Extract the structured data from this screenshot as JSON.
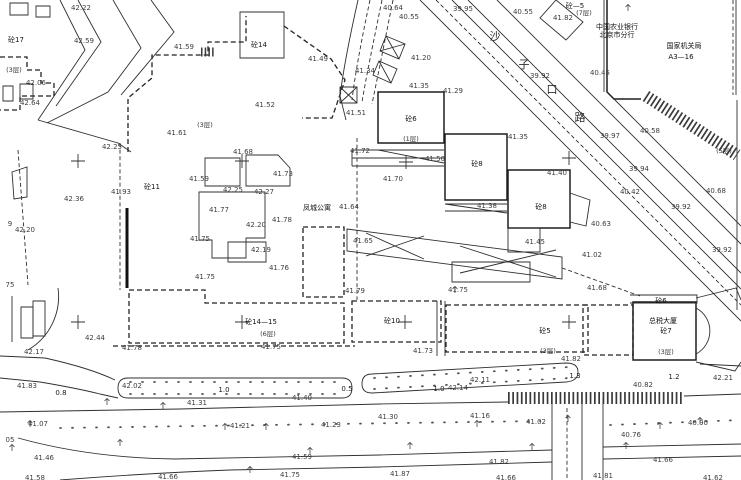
{
  "canvas": {
    "width": 741,
    "height": 480,
    "background": "#ffffff",
    "ink_color": "#2f2f2f",
    "label_color": "#3d3d3d"
  },
  "map": {
    "street_chars": [
      [
        "沙",
        495,
        38
      ],
      [
        "子",
        524,
        66
      ],
      [
        "口",
        552,
        91
      ],
      [
        "路",
        580,
        119
      ]
    ],
    "names": [
      [
        "中国农业银行",
        617,
        27
      ],
      [
        "北京市分行",
        617,
        35
      ],
      [
        "国家机关局",
        684,
        46
      ],
      [
        "A3—16",
        681,
        57
      ],
      [
        "凤城公寓",
        317,
        208
      ],
      [
        "总税大厦",
        663,
        321
      ]
    ],
    "building_numbers": [
      [
        "砼17",
        16,
        40
      ],
      [
        "砼14",
        259,
        45
      ],
      [
        "砼—5",
        575,
        6
      ],
      [
        "砼11",
        152,
        187
      ],
      [
        "砼6",
        411,
        119
      ],
      [
        "砼8",
        477,
        164
      ],
      [
        "砼8",
        541,
        207
      ],
      [
        "砼14—15",
        261,
        322
      ],
      [
        "砼10",
        392,
        321
      ],
      [
        "砼5",
        545,
        331
      ],
      [
        "砼6",
        661,
        301
      ],
      [
        "砼7",
        666,
        331
      ]
    ],
    "floor_notes": [
      [
        "(3层)",
        14,
        70
      ],
      [
        "(3层)",
        205,
        125
      ],
      [
        "(7层)",
        584,
        13
      ],
      [
        "(1层)",
        411,
        139
      ],
      [
        "(5层)",
        724,
        151
      ],
      [
        "(6层)",
        268,
        334
      ],
      [
        "(3层)",
        548,
        351
      ],
      [
        "(3层)",
        666,
        352
      ]
    ],
    "spot_elevations": [
      [
        "42.22",
        81,
        8
      ],
      [
        "42.59",
        84,
        41
      ],
      [
        "41.59",
        184,
        47
      ],
      [
        "42.06",
        36,
        83
      ],
      [
        "42.64",
        30,
        103
      ],
      [
        "42.25",
        112,
        147
      ],
      [
        "41.61",
        177,
        133
      ],
      [
        "40.64",
        393,
        8
      ],
      [
        "40.55",
        409,
        17
      ],
      [
        "39.95",
        463,
        9
      ],
      [
        "40.55",
        523,
        12
      ],
      [
        "41.82",
        563,
        18
      ],
      [
        "40.45",
        600,
        73
      ],
      [
        "39.92",
        540,
        76
      ],
      [
        "40.58",
        650,
        131
      ],
      [
        "39.97",
        610,
        136
      ],
      [
        "41.35",
        518,
        137
      ],
      [
        "39.94",
        639,
        169
      ],
      [
        "40.42",
        630,
        192
      ],
      [
        "39.92",
        681,
        207
      ],
      [
        "40.68",
        716,
        191
      ],
      [
        "39.92",
        722,
        250
      ],
      [
        "41.49",
        318,
        59
      ],
      [
        "41.20",
        421,
        58
      ],
      [
        "41.34",
        365,
        71
      ],
      [
        "41.35",
        419,
        86
      ],
      [
        "41.29",
        453,
        91
      ],
      [
        "41.52",
        265,
        105
      ],
      [
        "41.51",
        356,
        113
      ],
      [
        "41.72",
        360,
        151
      ],
      [
        "41.50",
        435,
        159
      ],
      [
        "41.70",
        393,
        179
      ],
      [
        "41.38",
        487,
        206
      ],
      [
        "41.40",
        557,
        173
      ],
      [
        "40.63",
        601,
        224
      ],
      [
        "41.45",
        535,
        242
      ],
      [
        "41.02",
        592,
        255
      ],
      [
        "41.68",
        597,
        288
      ],
      [
        "41.93",
        121,
        192
      ],
      [
        "42.36",
        74,
        199
      ],
      [
        "42.20",
        25,
        230
      ],
      [
        "9",
        10,
        224
      ],
      [
        "75",
        10,
        285
      ],
      [
        "41.68",
        243,
        152
      ],
      [
        "41.59",
        199,
        179
      ],
      [
        "42.25",
        233,
        190
      ],
      [
        "42.27",
        264,
        192
      ],
      [
        "41.73",
        283,
        174
      ],
      [
        "41.77",
        219,
        210
      ],
      [
        "42.20",
        256,
        225
      ],
      [
        "41.78",
        282,
        220
      ],
      [
        "41.75",
        200,
        239
      ],
      [
        "42.19",
        261,
        250
      ],
      [
        "41.76",
        279,
        268
      ],
      [
        "41.75",
        205,
        277
      ],
      [
        "41.64",
        349,
        207
      ],
      [
        "41.65",
        363,
        241
      ],
      [
        "42.17",
        34,
        352
      ],
      [
        "42.44",
        95,
        338
      ],
      [
        "41.78",
        132,
        348
      ],
      [
        "41.83",
        27,
        386
      ],
      [
        "42.02",
        132,
        386
      ],
      [
        "41.31",
        197,
        403
      ],
      [
        "41.07",
        38,
        424
      ],
      [
        "05",
        10,
        440
      ],
      [
        "41.46",
        44,
        458
      ],
      [
        "41.58",
        35,
        478
      ],
      [
        "41.66",
        168,
        477
      ],
      [
        "41.79",
        355,
        291
      ],
      [
        "41.75",
        271,
        347
      ],
      [
        "41.40",
        302,
        398
      ],
      [
        "41.21",
        240,
        426
      ],
      [
        "41.23",
        331,
        425
      ],
      [
        "41.59",
        302,
        457
      ],
      [
        "41.75",
        290,
        475
      ],
      [
        "41.75",
        458,
        290
      ],
      [
        "41.73",
        423,
        351
      ],
      [
        "41.82",
        571,
        359
      ],
      [
        "42.11",
        480,
        380
      ],
      [
        "42.14",
        458,
        388
      ],
      [
        "41.30",
        388,
        417
      ],
      [
        "41.16",
        480,
        416
      ],
      [
        "41.02",
        536,
        422
      ],
      [
        "41.82",
        499,
        462
      ],
      [
        "41.87",
        400,
        474
      ],
      [
        "41.66",
        506,
        478
      ],
      [
        "42.21",
        723,
        378
      ],
      [
        "40.82",
        643,
        385
      ],
      [
        "40.90",
        698,
        423
      ],
      [
        "40.76",
        631,
        435
      ],
      [
        "41.66",
        663,
        460
      ],
      [
        "41.81",
        603,
        476
      ],
      [
        "41.62",
        713,
        478
      ]
    ],
    "distance_marks": [
      [
        "0.8",
        61,
        393
      ],
      [
        "1.0",
        224,
        390
      ],
      [
        "0.5",
        347,
        389
      ],
      [
        "1.0",
        439,
        389
      ],
      [
        "1.3",
        575,
        376
      ],
      [
        "1.2",
        674,
        377
      ]
    ],
    "grid_crosses": [
      [
        78,
        161
      ],
      [
        242,
        161
      ],
      [
        406,
        162
      ],
      [
        569,
        158
      ],
      [
        78,
        322
      ],
      [
        242,
        322
      ],
      [
        405,
        322
      ],
      [
        569,
        322
      ]
    ],
    "tree_symbols": [
      [
        107,
        402
      ],
      [
        163,
        406
      ],
      [
        225,
        427
      ],
      [
        266,
        427
      ],
      [
        310,
        451
      ],
      [
        410,
        446
      ],
      [
        477,
        424
      ],
      [
        532,
        447
      ],
      [
        568,
        419
      ],
      [
        626,
        446
      ],
      [
        660,
        426
      ],
      [
        700,
        421
      ],
      [
        12,
        448
      ],
      [
        120,
        443
      ],
      [
        250,
        470
      ],
      [
        455,
        290
      ],
      [
        30,
        424
      ],
      [
        628,
        8
      ]
    ],
    "linework": {
      "paths": [
        {
          "d": "M60,0 L85,50 L38,120",
          "c": "s"
        },
        {
          "d": "M78,0 L101,42 L56,106",
          "c": "s"
        },
        {
          "d": "M113,0 L141,48 L108,92 L47,123",
          "c": "s"
        },
        {
          "d": "M151,0 L174,32 L121,95",
          "c": "s"
        },
        {
          "d": "M38,120 L118,143 L131,152",
          "c": "s"
        },
        {
          "d": "M10,3 L28,3 L28,15 L10,15 Z",
          "c": "s"
        },
        {
          "d": "M36,6 L50,6 L50,17 L36,17 Z",
          "c": "s"
        },
        {
          "d": "M0,57 L27,57 L27,70 L41,70 L41,83 L54,83 L54,96 L20,96 L20,110 L0,110",
          "c": "D"
        },
        {
          "d": "M3,86 L13,86 L13,101 L3,101 Z",
          "c": "s"
        },
        {
          "d": "M20,84 L33,84 L33,99 L20,99 Z",
          "c": "s"
        },
        {
          "d": "M12,172 L27,167 L27,197 L14,199 Z",
          "c": "s"
        },
        {
          "d": "M18,150 L28,285",
          "c": "d"
        },
        {
          "d": "M128,152 L128,98 L152,78 L152,55 L208,55 L208,42 L246,42 L246,16",
          "c": "D"
        },
        {
          "d": "M240,12 L284,12 L284,58 L240,58 Z",
          "c": "s"
        },
        {
          "d": "M284,26 L331,59 L345,80 L332,118 L302,118",
          "c": "D"
        },
        {
          "d": "M120,143 L120,290",
          "c": "d"
        },
        {
          "d": "M127,208 L127,288",
          "c": "B"
        },
        {
          "d": "M357,138 L357,300",
          "c": "d"
        },
        {
          "d": "M113,346 L355,346",
          "c": "D"
        },
        {
          "d": "M205,158 L240,158 L240,186 L205,186 Z",
          "c": "s"
        },
        {
          "d": "M246,155 L278,155 L290,168 L290,186 L246,186 Z",
          "c": "s"
        },
        {
          "d": "M199,192 L265,192 L265,238 L246,238 L246,258 L212,258 L212,240 L199,240 Z",
          "c": "s"
        },
        {
          "d": "M228,242 L266,242 L266,262 L228,262 Z",
          "c": "s"
        },
        {
          "d": "M303,227 L344,227 L344,297 L303,297 Z",
          "c": "D"
        },
        {
          "d": "M129,290 L205,290 L205,303 L344,303 L344,343 L129,343 Z",
          "c": "D"
        },
        {
          "d": "M352,301 L441,301 L441,342 L352,342 Z",
          "c": "D"
        },
        {
          "d": "M437,301 L437,356 M445,301 L445,356",
          "c": "s"
        },
        {
          "d": "M446,305 L588,305 L588,352 L446,352 Z",
          "c": "D"
        },
        {
          "d": "M583,305 L633,305 L633,355 L583,355 Z",
          "c": "D"
        },
        {
          "d": "M633,302 L696,302 L696,360 L633,360 Z",
          "c": "b"
        },
        {
          "d": "M630,295 L697,295 L697,303 L630,303",
          "c": "s"
        },
        {
          "d": "M696,308 A26,26 0 0 1 696,354",
          "c": "s"
        },
        {
          "d": "M696,298 L736,288 L741,300",
          "c": "s"
        },
        {
          "d": "M696,362 L735,371 L741,362",
          "c": "s"
        },
        {
          "d": "M378,92 L444,92 L444,143 L378,143 Z",
          "c": "b"
        },
        {
          "d": "M352,150 L444,150 M352,158 L444,158 M352,166 L444,166",
          "c": "s"
        },
        {
          "d": "M378,150 L444,163",
          "c": "s"
        },
        {
          "d": "M352,150 L352,166",
          "c": "s"
        },
        {
          "d": "M445,134 L507,134 L507,200 L445,200 Z",
          "c": "b"
        },
        {
          "d": "M445,204 L507,204 M445,211 L507,211 M445,204 L507,213",
          "c": "s"
        },
        {
          "d": "M508,170 L570,170 L570,228 L508,228 Z",
          "c": "b"
        },
        {
          "d": "M570,193 L590,200 L586,226 L570,222 Z",
          "c": "s"
        },
        {
          "d": "M508,228 L540,228 L540,252 L508,252 Z",
          "c": "s"
        },
        {
          "d": "M347,229 L562,257 L562,279 L347,251 Z",
          "c": "s"
        },
        {
          "d": "M366,233 L424,259 M424,236 L366,256",
          "c": "s"
        },
        {
          "d": "M460,246 L556,277 M556,250 L460,273",
          "c": "s"
        },
        {
          "d": "M452,262 L530,262 L530,282 L452,282 Z",
          "c": "s"
        },
        {
          "d": "M562,268 L640,296",
          "c": "d"
        },
        {
          "d": "M607,0 L607,92 L614,99 L641,99",
          "c": "b"
        },
        {
          "d": "M604,0 L604,92",
          "c": "s"
        },
        {
          "d": "M556,0 L583,22 L566,40 L540,18 Z",
          "c": "s"
        },
        {
          "d": "M420,0 L741,321",
          "c": "s"
        },
        {
          "d": "M452,0 L741,289",
          "c": "s"
        },
        {
          "d": "M468,0 L741,273",
          "c": "s"
        },
        {
          "d": "M497,0 L741,244",
          "c": "s"
        },
        {
          "d": "M614,99 L741,226",
          "c": "s"
        },
        {
          "d": "M436,0 L741,305",
          "c": "d"
        },
        {
          "d": "M737,100 L737,310",
          "c": "s"
        },
        {
          "d": "M736,0 L736,95",
          "c": "s"
        },
        {
          "d": "M733,0 L733,95",
          "c": "d"
        },
        {
          "d": "M358,0 C349,40 343,72 340,96 L346,120",
          "c": "s"
        },
        {
          "d": "M370,0 C361,42 355,75 352,100",
          "c": "d"
        },
        {
          "d": "M382,0 C373,44 366,78 362,102",
          "c": "d"
        },
        {
          "d": "M393,0 C384,45 377,80 372,104",
          "c": "d"
        },
        {
          "d": "M386,36 L405,44 L399,59 L380,51 Z M386,36 L399,59 M405,44 L380,51",
          "c": "s"
        },
        {
          "d": "M379,61 L397,69 L391,83 L373,75 Z M379,61 L391,83",
          "c": "s"
        },
        {
          "d": "M340,87 L357,87 L357,103 L340,103 Z M340,87 L357,103 M357,87 L340,103",
          "c": "s"
        },
        {
          "d": "M58,288 A62,62 0 0 1 28,350",
          "c": "s"
        },
        {
          "d": "M0,356 L45,358 Q90,368 115,380",
          "c": "s"
        },
        {
          "d": "M0,378 L40,382 Q76,388 100,394 L118,398",
          "c": "s"
        },
        {
          "d": "M128,378 L342,378 Q352,378 352,388 Q352,398 342,398 L128,398 Q118,398 118,388 Q118,378 128,378 Z",
          "c": "s"
        },
        {
          "d": "M372,374 L566,363 Q578,363 578,372 Q578,381 566,382 L372,393 Q362,393 362,384 Q362,374 372,374 Z",
          "c": "s"
        },
        {
          "d": "M0,412 L180,409 L380,404 L508,402",
          "c": "s"
        },
        {
          "d": "M684,396 L741,394",
          "c": "s"
        },
        {
          "d": "M700,364 L741,366",
          "c": "s"
        },
        {
          "d": "M12,296 L12,342",
          "c": "s"
        },
        {
          "d": "M21,307 L33,307 L33,338 L21,338 Z",
          "c": "s"
        },
        {
          "d": "M33,301 L45,301 L45,336 L33,336 Z",
          "c": "s"
        },
        {
          "d": "M552,404 L552,480",
          "c": "s"
        },
        {
          "d": "M582,400 L582,480",
          "c": "s"
        },
        {
          "d": "M603,398 L603,480",
          "c": "s"
        },
        {
          "d": "M567,408 L567,480",
          "c": "d"
        },
        {
          "d": "M18,438 Q90,458 175,459 L380,455 L552,450",
          "c": "s"
        },
        {
          "d": "M603,447 L741,444",
          "c": "s"
        },
        {
          "d": "M60,480 Q150,473 230,470 L380,467 L552,462",
          "c": "s"
        },
        {
          "d": "M603,459 L741,456",
          "c": "s"
        }
      ],
      "dotted": [
        "M130,382 L344,382",
        "M130,394 L344,394",
        "M374,378 L570,367",
        "M374,389 L570,378",
        "M60,428 L540,421",
        "M610,425 L741,420"
      ],
      "hatch": [
        {
          "d": "M646,96 L737,155",
          "c": "h"
        },
        {
          "d": "M508,398 L683,398",
          "c": "h"
        },
        {
          "d": "M201,52 L214,52",
          "c": "h2"
        }
      ]
    }
  }
}
